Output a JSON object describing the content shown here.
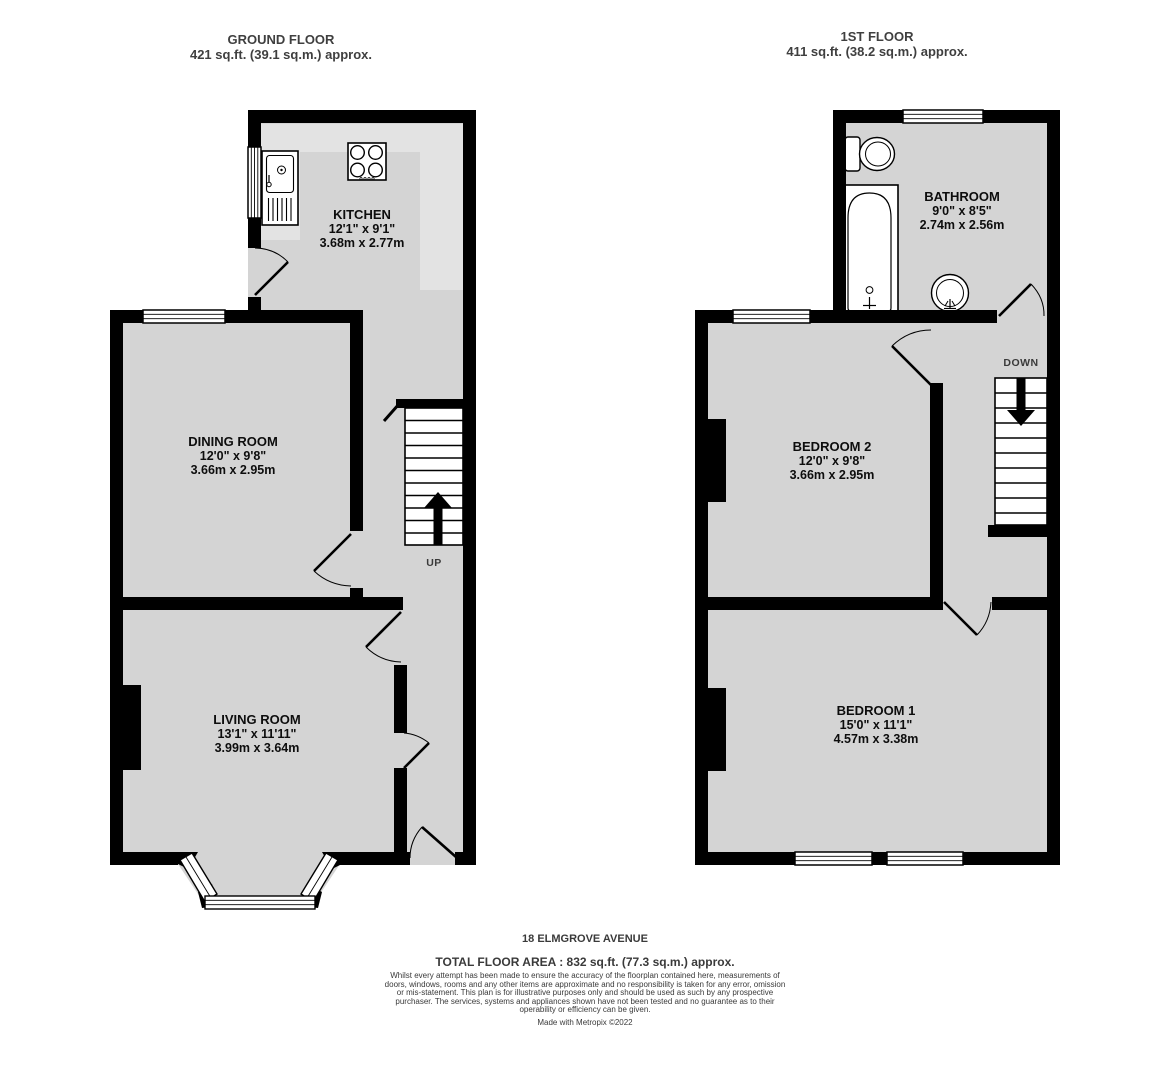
{
  "colors": {
    "wall": "#000000",
    "floor_fill": "#d4d4d4",
    "counter_fill": "#e3e3e3",
    "title_text": "#3f3f3f",
    "label_text": "#0d0d0d"
  },
  "ground_floor": {
    "title": "GROUND FLOOR",
    "area": "421 sq.ft. (39.1 sq.m.) approx.",
    "stairs_label": "UP",
    "kitchen": {
      "name": "KITCHEN",
      "imperial": "12'1\"  x 9'1\"",
      "metric": "3.68m  x 2.77m"
    },
    "dining_room": {
      "name": "DINING ROOM",
      "imperial": "12'0\"  x 9'8\"",
      "metric": "3.66m  x 2.95m"
    },
    "living_room": {
      "name": "LIVING ROOM",
      "imperial": "13'1\"  x 11'11\"",
      "metric": "3.99m  x 3.64m"
    }
  },
  "first_floor": {
    "title": "1ST FLOOR",
    "area": "411 sq.ft. (38.2 sq.m.) approx.",
    "stairs_label": "DOWN",
    "bathroom": {
      "name": "BATHROOM",
      "imperial": "9'0\"  x 8'5\"",
      "metric": "2.74m  x 2.56m"
    },
    "bedroom_2": {
      "name": "BEDROOM 2",
      "imperial": "12'0\"  x 9'8\"",
      "metric": "3.66m  x 2.95m"
    },
    "bedroom_1": {
      "name": "BEDROOM 1",
      "imperial": "15'0\"  x 11'1\"",
      "metric": "4.57m  x 3.38m"
    }
  },
  "footer": {
    "address": "18 ELMGROVE AVENUE",
    "total_area": "TOTAL FLOOR AREA : 832 sq.ft. (77.3 sq.m.) approx.",
    "disclaimer": "Whilst every attempt has been made to ensure the accuracy of the floorplan contained here, measurements of doors, windows, rooms and any other items are approximate and no responsibility is taken for any error, omission or mis-statement. This plan is for illustrative purposes only and should be used as such by any prospective purchaser. The services, systems and appliances shown have not been tested and no guarantee as to their operability or efficiency can be given.",
    "credit": "Made with Metropix ©2022"
  }
}
